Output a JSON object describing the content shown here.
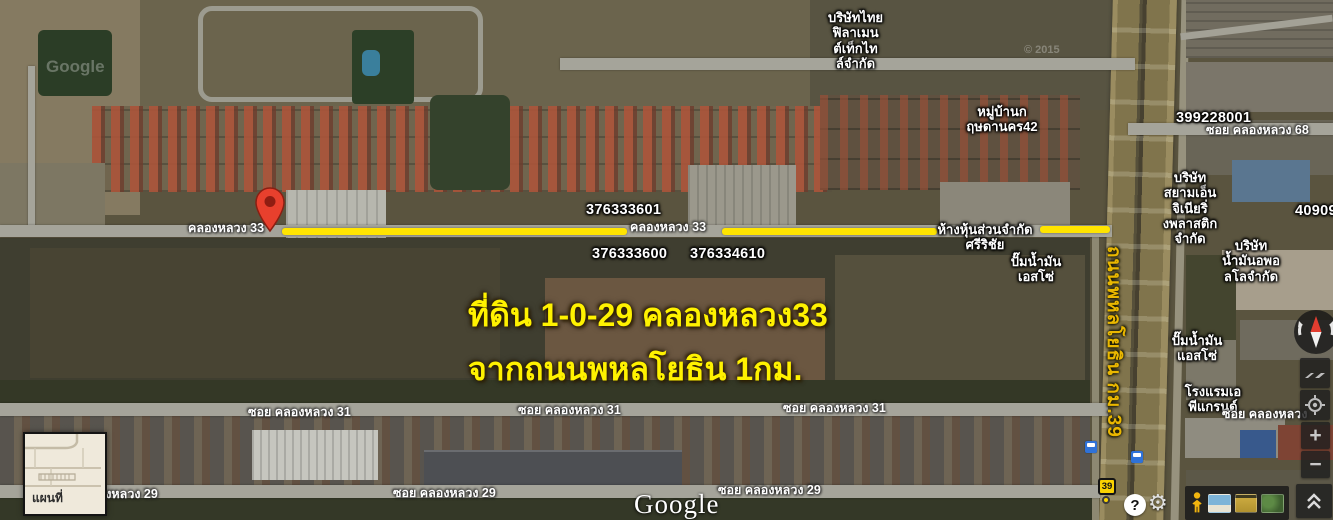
{
  "labels": {
    "company_filament": "บริษัทไทย\nฟิลาเมน\nต์เท็กไท\nล์จำกัด",
    "village": "หมู่บ้านก\nฤษดานคร42",
    "parcel_a": "399228001",
    "soi68": "ซอย คลองหลวง 68",
    "company_siam": "บริษัท\nสยามเอ็น\nจิเนียริ่\nงพลาสติก\nจำกัด",
    "parcel_b": "40909",
    "company_apollo": "บริษัท\nน้ำมันอพอ\nลโลจำกัด",
    "klongluang33": "คลองหลวง 33",
    "parcel_c": "376333601",
    "parcel_d": "376333600",
    "parcel_e": "376334610",
    "partnership": "ห้างหุ้นส่วนจำกัด\nศรีริชัย",
    "esso1": "ปั๊มน้ำมัน\nเอสโซ่",
    "esso2": "ปั๊มน้ำมัน\nแอสโซ่",
    "hotel": "โรงแรมเอ\nพีแกรนด์",
    "soi_right": "ซอย คลองหลวง",
    "soi31": "ซอย คลองหลวง 31",
    "soi29": "ซอย คลองหลวง 29",
    "highway": "ถนนพหลโยธิน กม.39",
    "annotation1": "ที่ดิน 1-0-29 คลองหลวง33",
    "annotation2": "จากถนนพหลโยธิน 1กม.",
    "watermark": "Google",
    "copyright": "© 2015",
    "logo": "Google",
    "minimap": "แผนที่",
    "route_shield": "39"
  },
  "controls": {
    "zoom_in": "+",
    "zoom_out": "−",
    "help": "?",
    "gear": "⚙"
  },
  "colors": {
    "highlight_line": "#ffe400",
    "annotation_text": "#fff200",
    "highway_text": "#eab700",
    "marker": "#e8402d",
    "transit_icon": "#2f72d8",
    "route_shield_bg": "#fad201"
  }
}
